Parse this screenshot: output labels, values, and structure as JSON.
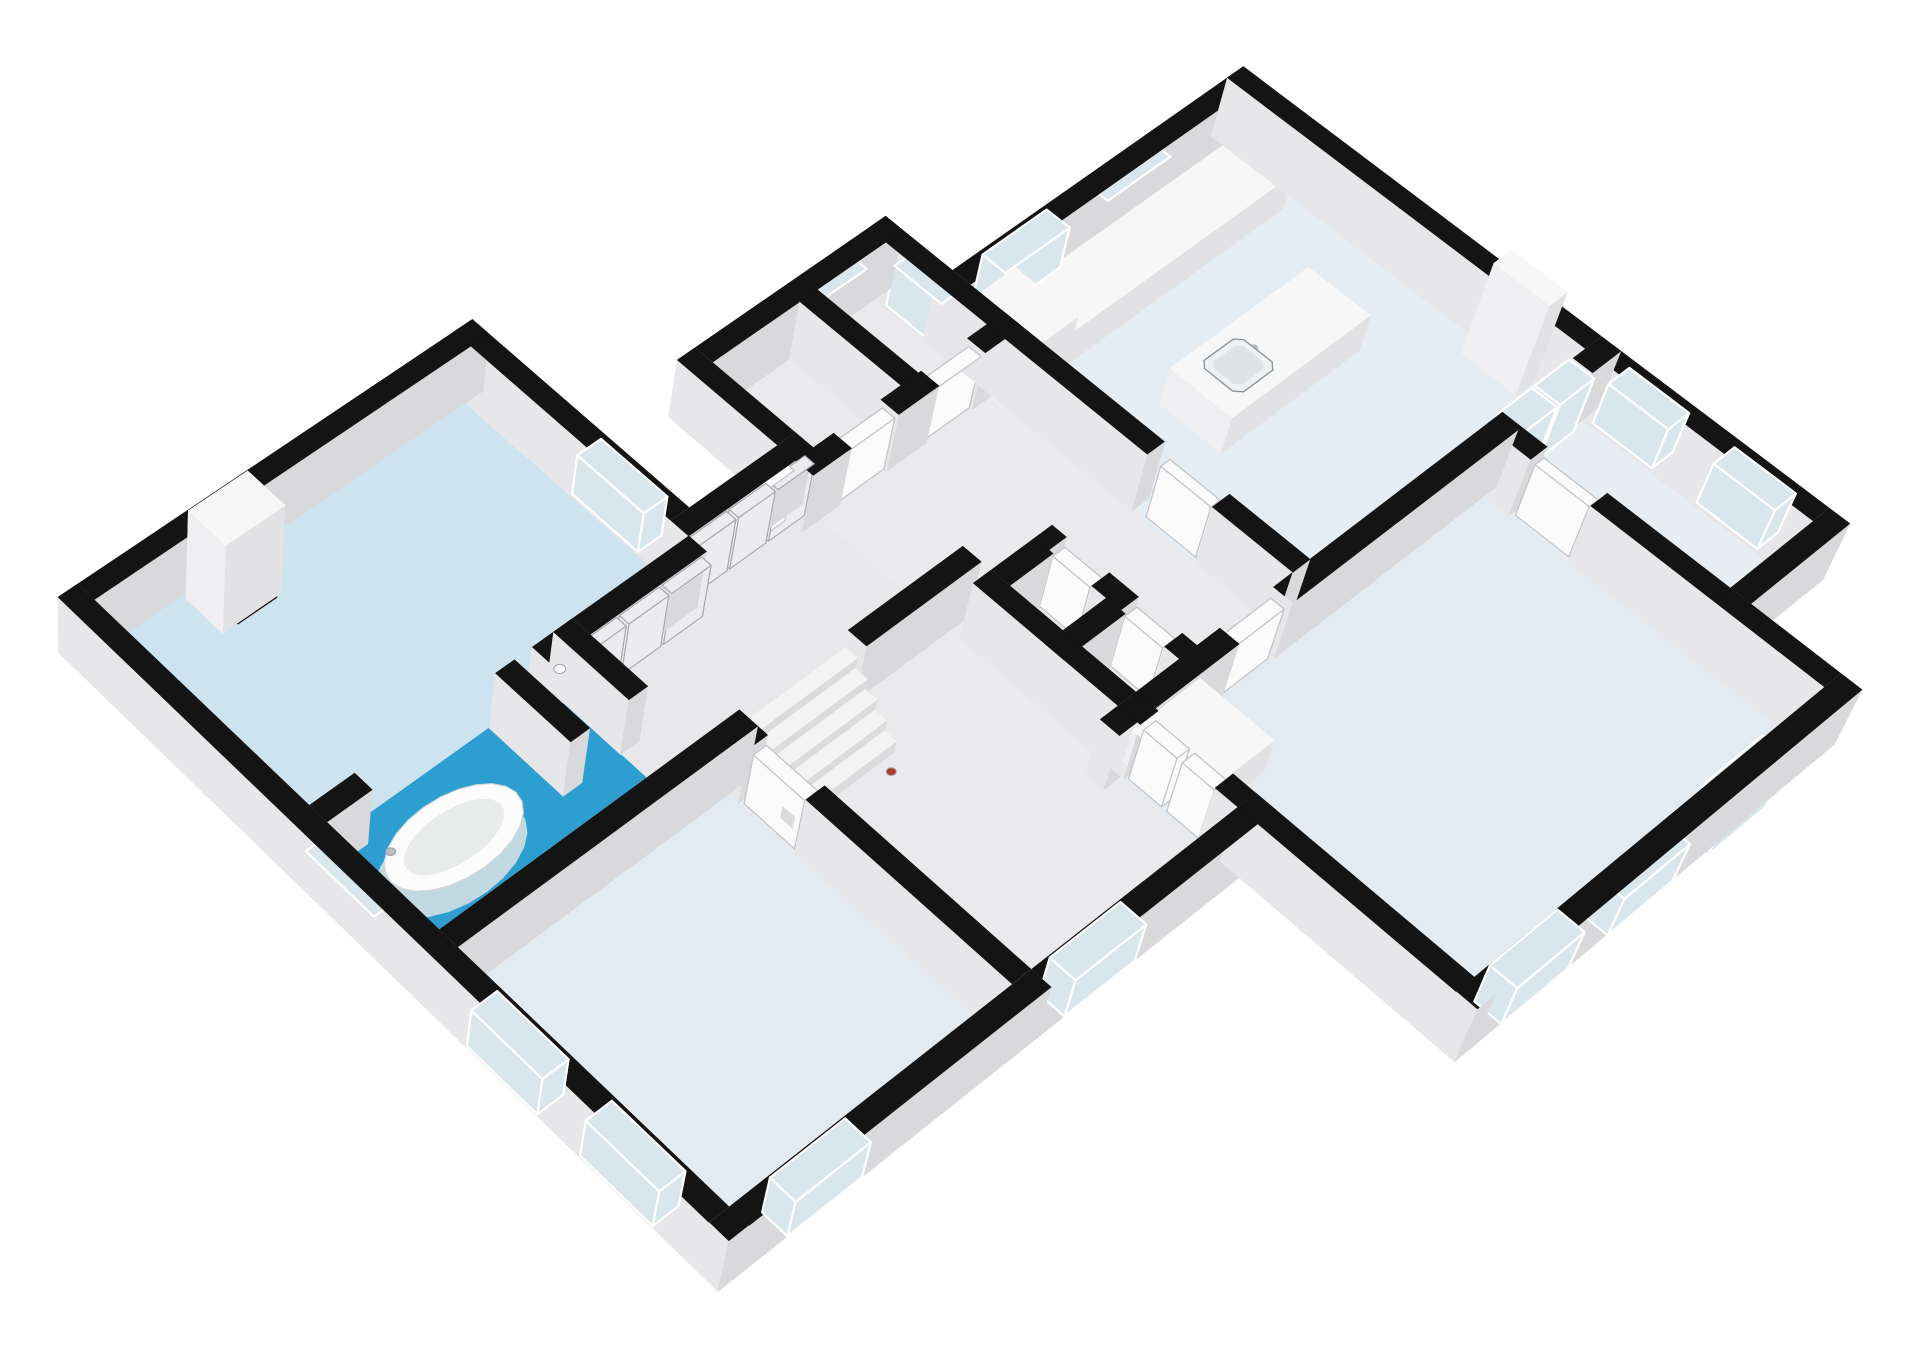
{
  "view": {
    "canvas_width": 1920,
    "canvas_height": 1358,
    "background": "#ffffff",
    "render_style": "3d-axonometric-floorplan"
  },
  "palette": {
    "wallTop": "#141414",
    "wallS": "#d9d9dc",
    "wallW": "#e7e7ea",
    "wallE": "#cdcdd1",
    "wallN": "#f0f0f2",
    "boxTop": "#f7f7f8",
    "boxS": "#e2e2e5",
    "boxW": "#efeff1",
    "boxE": "#d7d7da",
    "boxN": "#f3f3f5",
    "stepTop": "#f3f3f4",
    "stepFace": "#dbdbde",
    "glass": "#d9e6ed",
    "frame": "#ffffff",
    "door": "#fbfbfc",
    "doorEdge": "#c5c5ca",
    "closet": "#ececef",
    "closetEdge": "#a8a8ae",
    "floorLiving": "#cde3f0",
    "floorBath": "#2d9ed0",
    "floorGray": "#e8e8ea",
    "floorGray2": "#eaeaec",
    "floorKitchen": "#e3edf3",
    "floorBed": "#e2ebf2",
    "floorPale": "#e6eef4",
    "stove": "#35373a",
    "burner": "#c9cdd0",
    "sinkOuter": "#eef1f1",
    "sinkInner": "#dfe3e4",
    "metal": "#b9bfc4",
    "tubWhite": "#fcfcfd",
    "tubInner": "#e9ebeb",
    "tubShadow": "#c3d9e2",
    "decorRed": "#b03a2e",
    "fireStops": [
      "#2b0e02",
      "#8a2a04",
      "#f07f12",
      "#ffc84d",
      "#ffe9a8"
    ],
    "fireOffsets": [
      0,
      0.3,
      0.6,
      0.82,
      1
    ]
  },
  "scene": {
    "projection": {
      "theta": 40,
      "phi": 36,
      "D": 5000,
      "f": 5000,
      "wallH": 96,
      "pad": 60
    },
    "rooms": [
      {
        "id": "living-room",
        "rect": [
          0,
          0,
          520,
          330
        ],
        "floor": "floorLiving"
      },
      {
        "id": "bathroom",
        "rect": [
          0,
          330,
          330,
          520
        ],
        "floor": "floorBath"
      },
      {
        "id": "closet-corridor",
        "rect": [
          330,
          330,
          700,
          520
        ],
        "floor": "floorGray"
      },
      {
        "id": "storage-1",
        "rect": [
          700,
          180,
          830,
          330
        ],
        "floor": "floorGray2"
      },
      {
        "id": "storage-2",
        "rect": [
          830,
          180,
          960,
          330
        ],
        "floor": "floorGray2"
      },
      {
        "id": "hall-north",
        "rect": [
          700,
          330,
          960,
          760
        ],
        "floor": "floorGray2"
      },
      {
        "id": "wc-1",
        "rect": [
          700,
          560,
          790,
          660
        ],
        "floor": "floorGray"
      },
      {
        "id": "wc-2",
        "rect": [
          700,
          660,
          790,
          760
        ],
        "floor": "floorGray"
      },
      {
        "id": "kitchen",
        "rect": [
          960,
          280,
          1420,
          760
        ],
        "floor": "floorKitchen"
      },
      {
        "id": "hall-main",
        "rect": [
          380,
          520,
          700,
          920
        ],
        "floor": "floorGray2"
      },
      {
        "id": "bedroom-west",
        "rect": [
          0,
          520,
          380,
          920
        ],
        "floor": "floorBed"
      },
      {
        "id": "bedroom-south",
        "rect": [
          700,
          760,
          1260,
          1200
        ],
        "floor": "floorBed"
      },
      {
        "id": "bedroom-east",
        "rect": [
          1260,
          760,
          1420,
          1060
        ],
        "floor": "floorPale"
      }
    ],
    "walls": [
      [
        -26,
        -26,
        546,
        0
      ],
      [
        -26,
        -26,
        0,
        946
      ],
      [
        -26,
        920,
        406,
        946
      ],
      [
        380,
        920,
        726,
        946
      ],
      [
        700,
        920,
        726,
        1226
      ],
      [
        700,
        1200,
        1286,
        1226
      ],
      [
        1260,
        1060,
        1286,
        1226
      ],
      [
        1260,
        1060,
        1446,
        1086
      ],
      [
        1420,
        254,
        1446,
        1086
      ],
      [
        960,
        254,
        1446,
        280
      ],
      [
        960,
        154,
        986,
        280
      ],
      [
        674,
        154,
        986,
        180
      ],
      [
        674,
        154,
        700,
        356
      ],
      [
        520,
        304,
        700,
        330
      ],
      [
        520,
        -26,
        546,
        330
      ],
      [
        -26,
        520,
        406,
        546
      ],
      [
        560,
        520,
        726,
        546
      ],
      [
        960,
        280,
        986,
        560
      ],
      [
        960,
        650,
        986,
        760
      ],
      [
        674,
        760,
        850,
        786
      ],
      [
        930,
        760,
        1280,
        786
      ],
      [
        1400,
        760,
        1446,
        786
      ],
      [
        700,
        560,
        726,
        760
      ],
      [
        790,
        560,
        816,
        580
      ],
      [
        790,
        640,
        816,
        680
      ],
      [
        790,
        740,
        816,
        760
      ],
      [
        700,
        560,
        790,
        586
      ],
      [
        700,
        660,
        790,
        686
      ],
      [
        -26,
        330,
        60,
        356
      ],
      [
        300,
        330,
        520,
        356
      ],
      [
        330,
        330,
        356,
        440
      ],
      [
        250,
        330,
        276,
        440
      ],
      [
        830,
        180,
        856,
        330
      ],
      [
        674,
        330,
        730,
        356
      ],
      [
        800,
        330,
        860,
        356
      ],
      [
        930,
        330,
        986,
        356
      ],
      [
        1260,
        760,
        1286,
        820
      ],
      [
        1260,
        900,
        1286,
        1060
      ],
      [
        700,
        760,
        726,
        790
      ],
      [
        700,
        890,
        726,
        920
      ],
      [
        380,
        520,
        406,
        560
      ],
      [
        380,
        640,
        406,
        920
      ]
    ],
    "windows": [
      {
        "rect": [
          -30,
          40,
          4,
          140
        ]
      },
      {
        "rect": [
          -30,
          170,
          4,
          270
        ]
      },
      {
        "rect": [
          -30,
          360,
          4,
          460
        ]
      },
      {
        "rect": [
          -30,
          600,
          4,
          700
        ]
      },
      {
        "rect": [
          -30,
          760,
          4,
          860
        ]
      },
      {
        "rect": [
          60,
          916,
          160,
          950
        ]
      },
      {
        "rect": [
          220,
          916,
          320,
          950
        ]
      },
      {
        "rect": [
          440,
          916,
          540,
          950
        ]
      },
      {
        "rect": [
          516,
          40,
          550,
          140
        ]
      },
      {
        "rect": [
          516,
          170,
          550,
          270
        ]
      },
      {
        "rect": [
          850,
          150,
          930,
          184
        ]
      },
      {
        "rect": [
          956,
          200,
          990,
          270
        ]
      },
      {
        "rect": [
          1040,
          250,
          1140,
          284
        ]
      },
      {
        "rect": [
          1200,
          250,
          1300,
          284
        ]
      },
      {
        "rect": [
          1416,
          320,
          1450,
          410
        ]
      },
      {
        "rect": [
          1416,
          460,
          1450,
          550
        ]
      },
      {
        "rect": [
          1416,
          800,
          1450,
          880
        ]
      },
      {
        "rect": [
          1416,
          940,
          1450,
          1020
        ]
      },
      {
        "rect": [
          760,
          1196,
          860,
          1230
        ]
      },
      {
        "rect": [
          920,
          1196,
          1020,
          1230
        ]
      }
    ],
    "glassDoors": [
      {
        "rect": [
          1080,
          1196,
          1170,
          1230
        ]
      },
      {
        "rect": [
          1285,
          756,
          1340,
          790
        ]
      },
      {
        "rect": [
          1345,
          756,
          1400,
          790
        ]
      }
    ],
    "doors": [
      {
        "rect": [
          600,
          300,
          670,
          334
        ]
      },
      {
        "rect": [
          730,
          334,
          800,
          352
        ]
      },
      {
        "rect": [
          860,
          334,
          930,
          352
        ]
      },
      {
        "rect": [
          966,
          575,
          980,
          645
        ]
      },
      {
        "rect": [
          855,
          764,
          925,
          782
        ]
      },
      {
        "rect": [
          704,
          793,
          722,
          838
        ]
      },
      {
        "rect": [
          704,
          845,
          722,
          888
        ]
      },
      {
        "rect": [
          1266,
          824,
          1280,
          896
        ]
      },
      {
        "rect": [
          794,
          584,
          812,
          636
        ]
      },
      {
        "rect": [
          794,
          684,
          812,
          736
        ]
      },
      {
        "rect": [
          384,
          564,
          402,
          636
        ]
      }
    ],
    "closets": [
      {
        "rect": [
          340,
          354,
          396,
          368
        ]
      },
      {
        "rect": [
          400,
          354,
          456,
          368
        ]
      },
      {
        "rect": [
          460,
          354,
          516,
          368
        ]
      },
      {
        "rect": [
          524,
          328,
          577,
          342
        ]
      },
      {
        "rect": [
          581,
          328,
          634,
          342
        ]
      },
      {
        "rect": [
          638,
          328,
          691,
          342
        ]
      }
    ],
    "whiteBoxes": [
      {
        "id": "fireplace-chimney-living",
        "rect": [
          120,
          6,
          200,
          64
        ],
        "h": 150
      },
      {
        "id": "fireplace-chimney-kitchen",
        "rect": [
          1392,
          642,
          1420,
          718
        ],
        "h": 150
      },
      {
        "id": "kitchen-counter",
        "rect": [
          980,
          300,
          1400,
          378
        ],
        "h": 58
      },
      {
        "id": "fridge",
        "rect": [
          958,
          294,
          1042,
          384
        ],
        "h": 94
      },
      {
        "id": "kitchen-island",
        "rect": [
          1090,
          480,
          1310,
          568
        ],
        "h": 60
      },
      {
        "id": "bedroom-cabinet",
        "rect": [
          715,
          775,
          815,
          875
        ],
        "h": 56
      }
    ],
    "stairs": {
      "x0": 400,
      "x1": 545,
      "y0": 532,
      "stepDepth": 17,
      "steps": 5,
      "h0": 92,
      "dh": 18
    },
    "fires": [
      {
        "rect": [
          134,
          58,
          186,
          72
        ],
        "z": [
          14,
          60
        ]
      },
      {
        "rect": [
          1384,
          656,
          1398,
          704
        ],
        "z": [
          12,
          56
        ]
      }
    ],
    "stove": {
      "rect": [
        1235,
        310,
        1325,
        368
      ],
      "z": 58.5,
      "burners": [
        [
          1253,
          325
        ],
        [
          1253,
          353
        ],
        [
          1307,
          325
        ],
        [
          1307,
          353
        ]
      ],
      "r": 9
    },
    "sinks": [
      {
        "outer": [
          1118,
          496,
          1180,
          552
        ],
        "inner": [
          1126,
          504,
          1172,
          544
        ],
        "faucet": [
          1175,
          521
        ],
        "z": 60.5
      },
      {
        "outer": [
          1208,
          496,
          1270,
          552
        ],
        "inner": [
          1216,
          504,
          1262,
          544
        ],
        "faucet": [
          1265,
          521
        ],
        "z": 60.5
      }
    ],
    "tub": {
      "cx": 112,
      "cy": 424,
      "rx": 84,
      "ry": 46,
      "irx": 62,
      "iry": 29,
      "z": 40
    },
    "circles": [
      {
        "c": [
          312,
          360,
          80
        ],
        "r": 6,
        "fill": "tubWhite",
        "name": "shower-head"
      },
      {
        "c": [
          48,
          400,
          48
        ],
        "r": 5,
        "fill": "metal",
        "name": "tub-faucet"
      },
      {
        "c": [
          520,
          636,
          10
        ],
        "r": 5,
        "fill": "decorRed",
        "name": "decor-item"
      }
    ]
  }
}
